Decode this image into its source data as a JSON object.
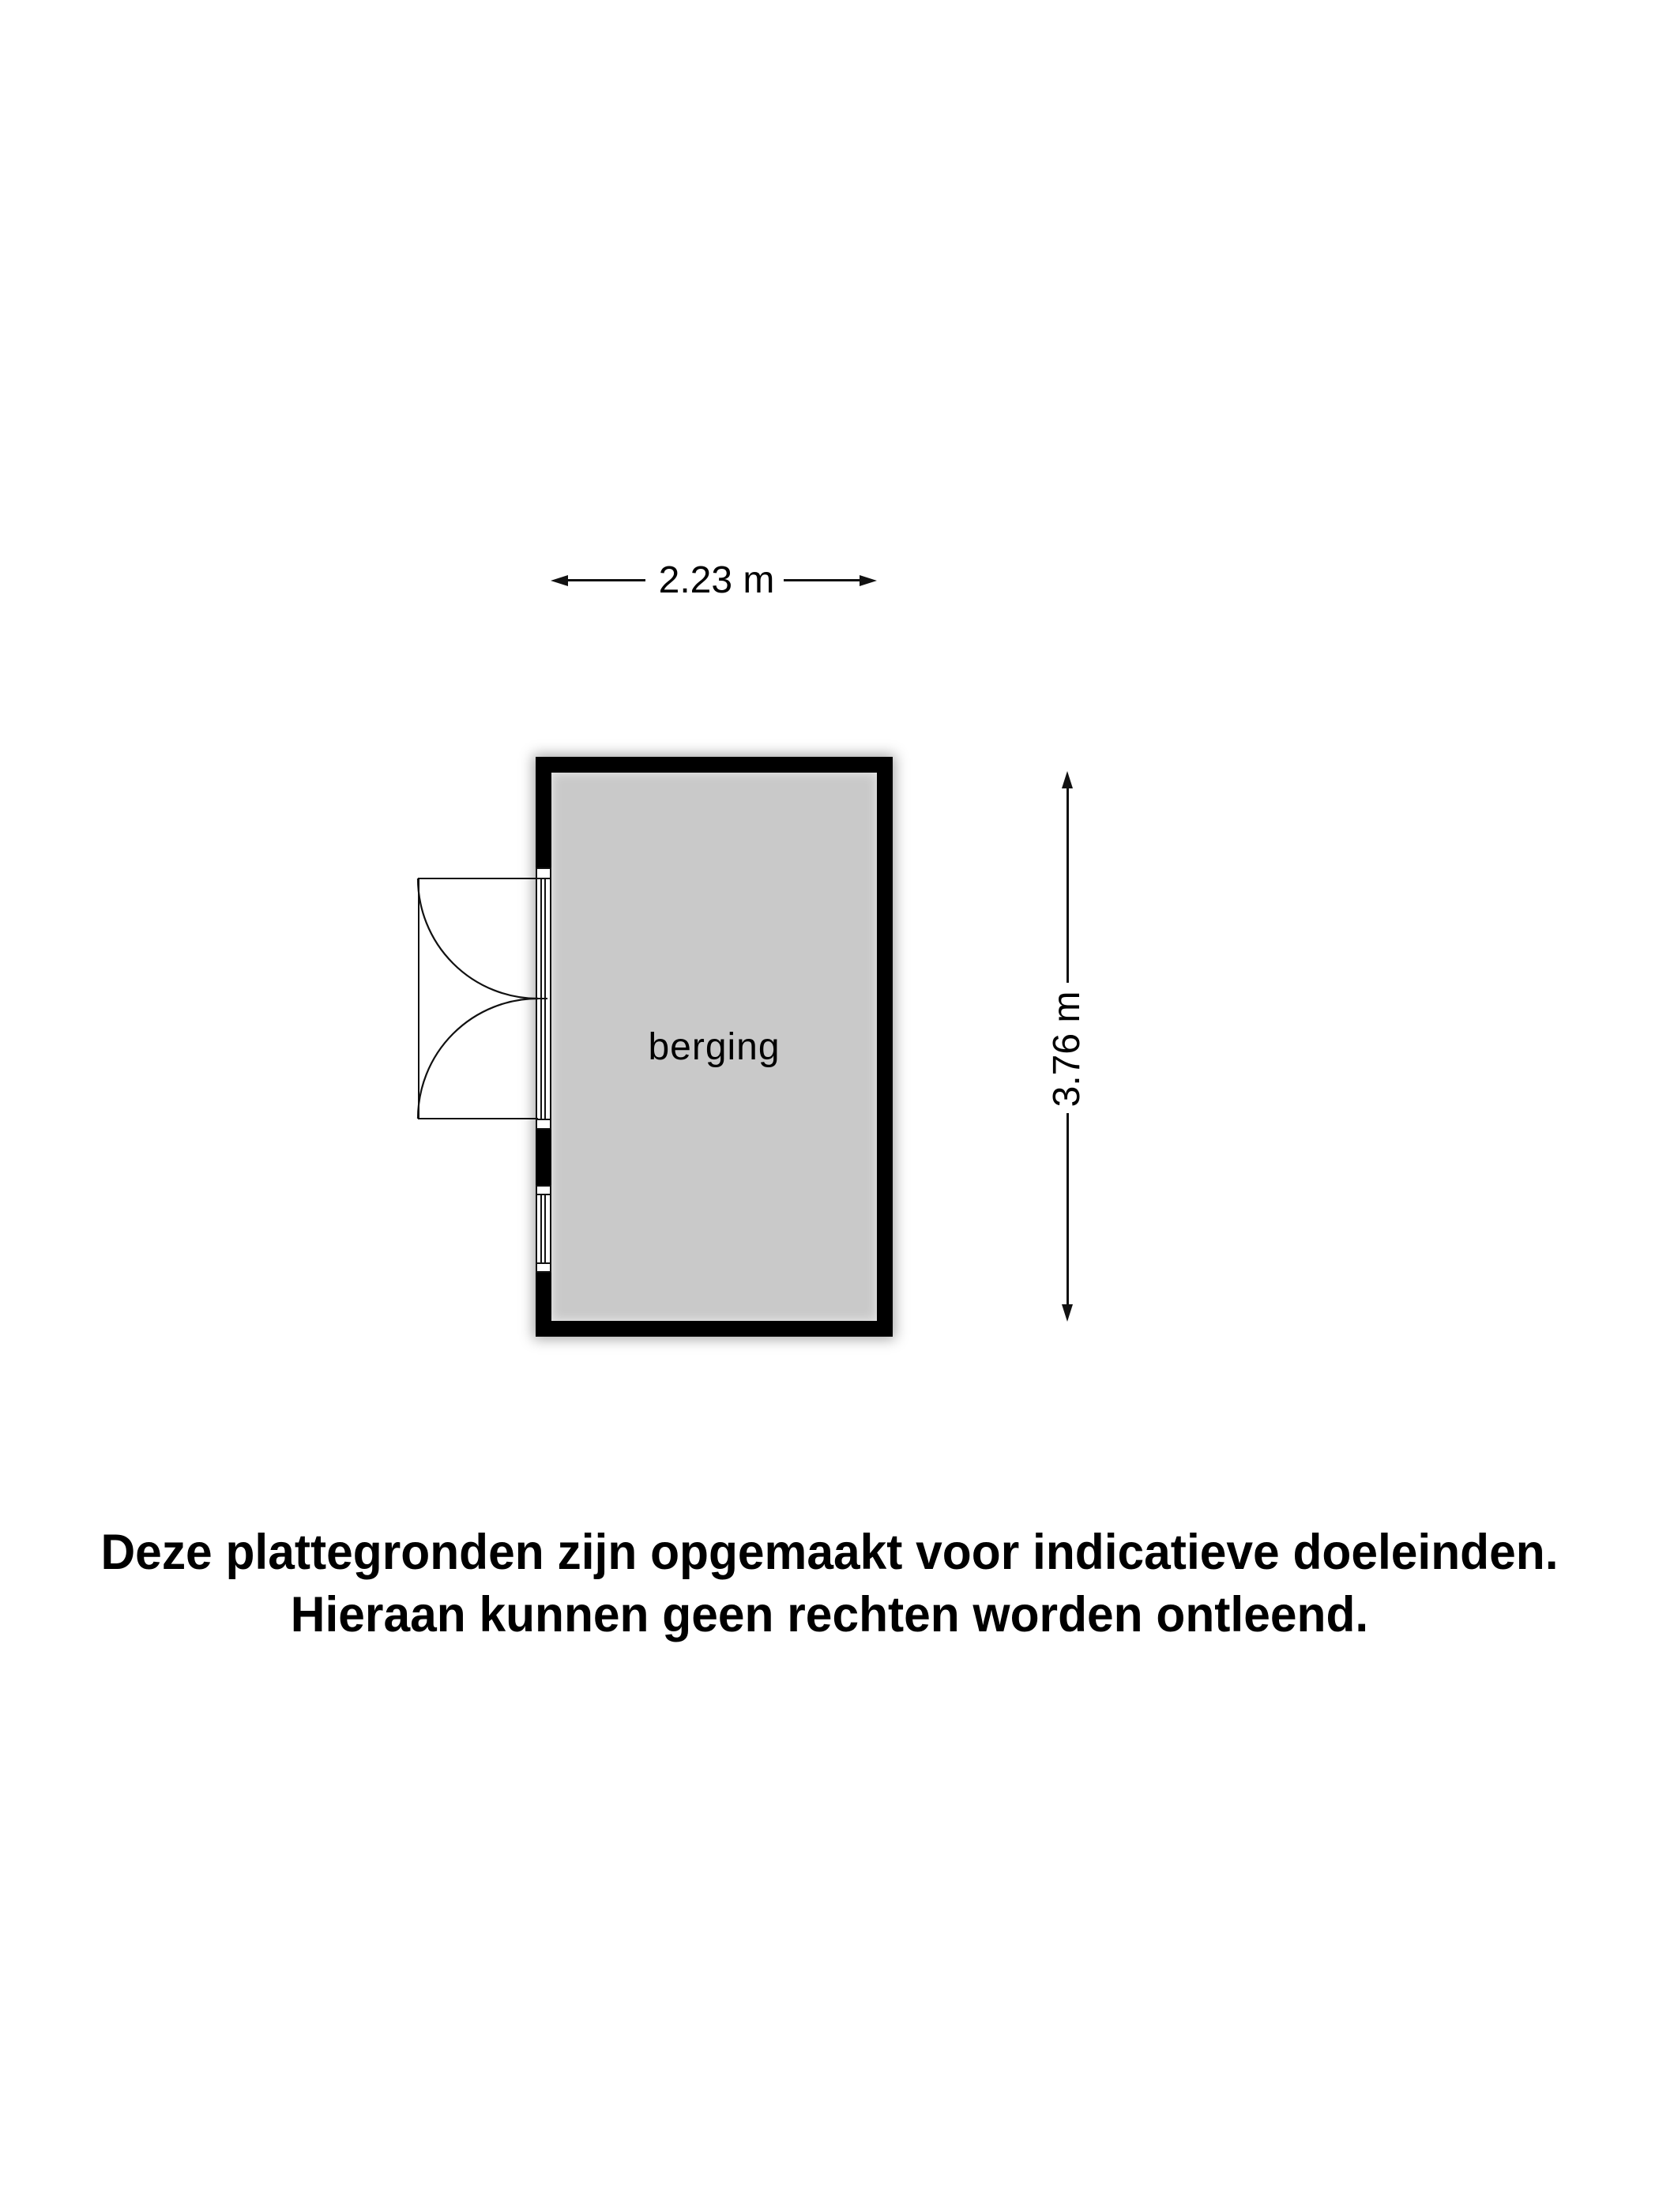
{
  "colors": {
    "background": "#ffffff",
    "wall": "#000000",
    "floor": "#c9c9c9",
    "line": "#111111",
    "text": "#000000"
  },
  "room": {
    "label": "berging"
  },
  "dimensions": {
    "width_label": "2.23 m",
    "height_label": "3.76 m"
  },
  "disclaimer": {
    "line1": "Deze plattegronden zijn opgemaakt voor indicatieve doeleinden.",
    "line2": "Hieraan kunnen geen rechten worden ontleend."
  }
}
